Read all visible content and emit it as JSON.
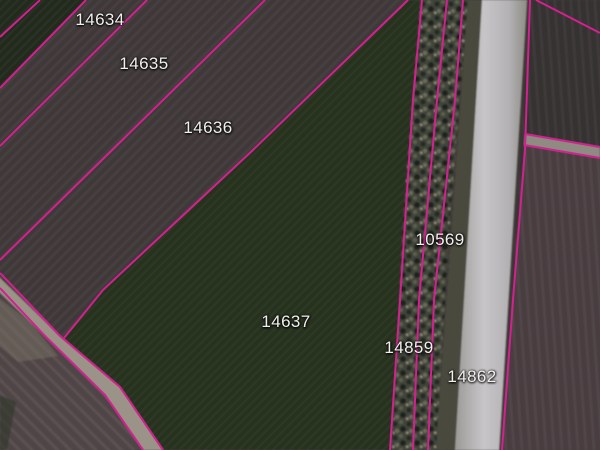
{
  "app": {
    "view": "cadastral-aerial-map"
  },
  "map": {
    "boundary_line_color": "#d42090",
    "label_text_color": "#f2f0ee",
    "parcels": [
      {
        "id": "14634"
      },
      {
        "id": "14635"
      },
      {
        "id": "14636"
      },
      {
        "id": "14637"
      },
      {
        "id": "10569"
      },
      {
        "id": "14859"
      },
      {
        "id": "14862"
      }
    ]
  }
}
